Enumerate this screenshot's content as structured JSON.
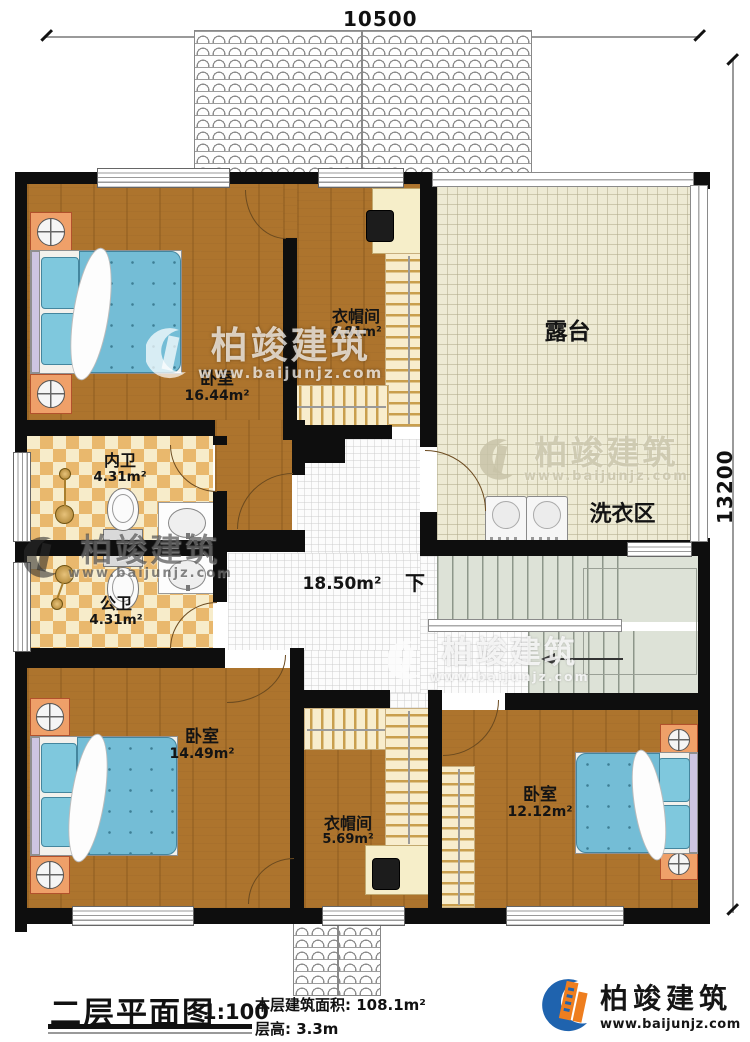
{
  "dimensions": {
    "width": "10500",
    "height": "13200"
  },
  "rooms": {
    "bedroom_tl": {
      "name": "卧室",
      "area": "16.44m²"
    },
    "cloakroom_top": {
      "name": "衣帽间",
      "area": "6.81m²"
    },
    "terrace": {
      "name": "露台"
    },
    "laundry": {
      "name": "洗衣区"
    },
    "bath_inner": {
      "name": "内卫",
      "area": "4.31m²"
    },
    "bath_public": {
      "name": "公卫",
      "area": "4.31m²"
    },
    "hall": {
      "area": "18.50m²"
    },
    "stairs": {
      "direction_label": "下"
    },
    "bedroom_bl": {
      "name": "卧室",
      "area": "14.49m²"
    },
    "cloakroom_bottom": {
      "name": "衣帽间",
      "area": "5.69m²"
    },
    "bedroom_br": {
      "name": "卧室",
      "area": "12.12m²"
    }
  },
  "watermark": {
    "name": "柏竣建筑",
    "url": "www.baijunjz.com"
  },
  "footer": {
    "title": "二层平面图",
    "scale": "1:100",
    "floor_area_label": "本层建筑面积:",
    "floor_area_value": "108.1m²",
    "floor_height_label": "层高:",
    "floor_height_value": "3.3m"
  },
  "brand": {
    "name": "柏竣建筑",
    "url": "www.baijunjz.com"
  },
  "colors": {
    "wall": "#0e0e0e",
    "wood": "#ad742d",
    "bed_blue": "#74bdd6",
    "tile_warm": "#e9b86d",
    "tile_cream": "#f7ecca",
    "terrace": "#edead4",
    "stair": "#dde2d7",
    "closet": "#f8edcd",
    "brand_blue": "#1f63ae",
    "brand_orange": "#ee7e1f"
  }
}
